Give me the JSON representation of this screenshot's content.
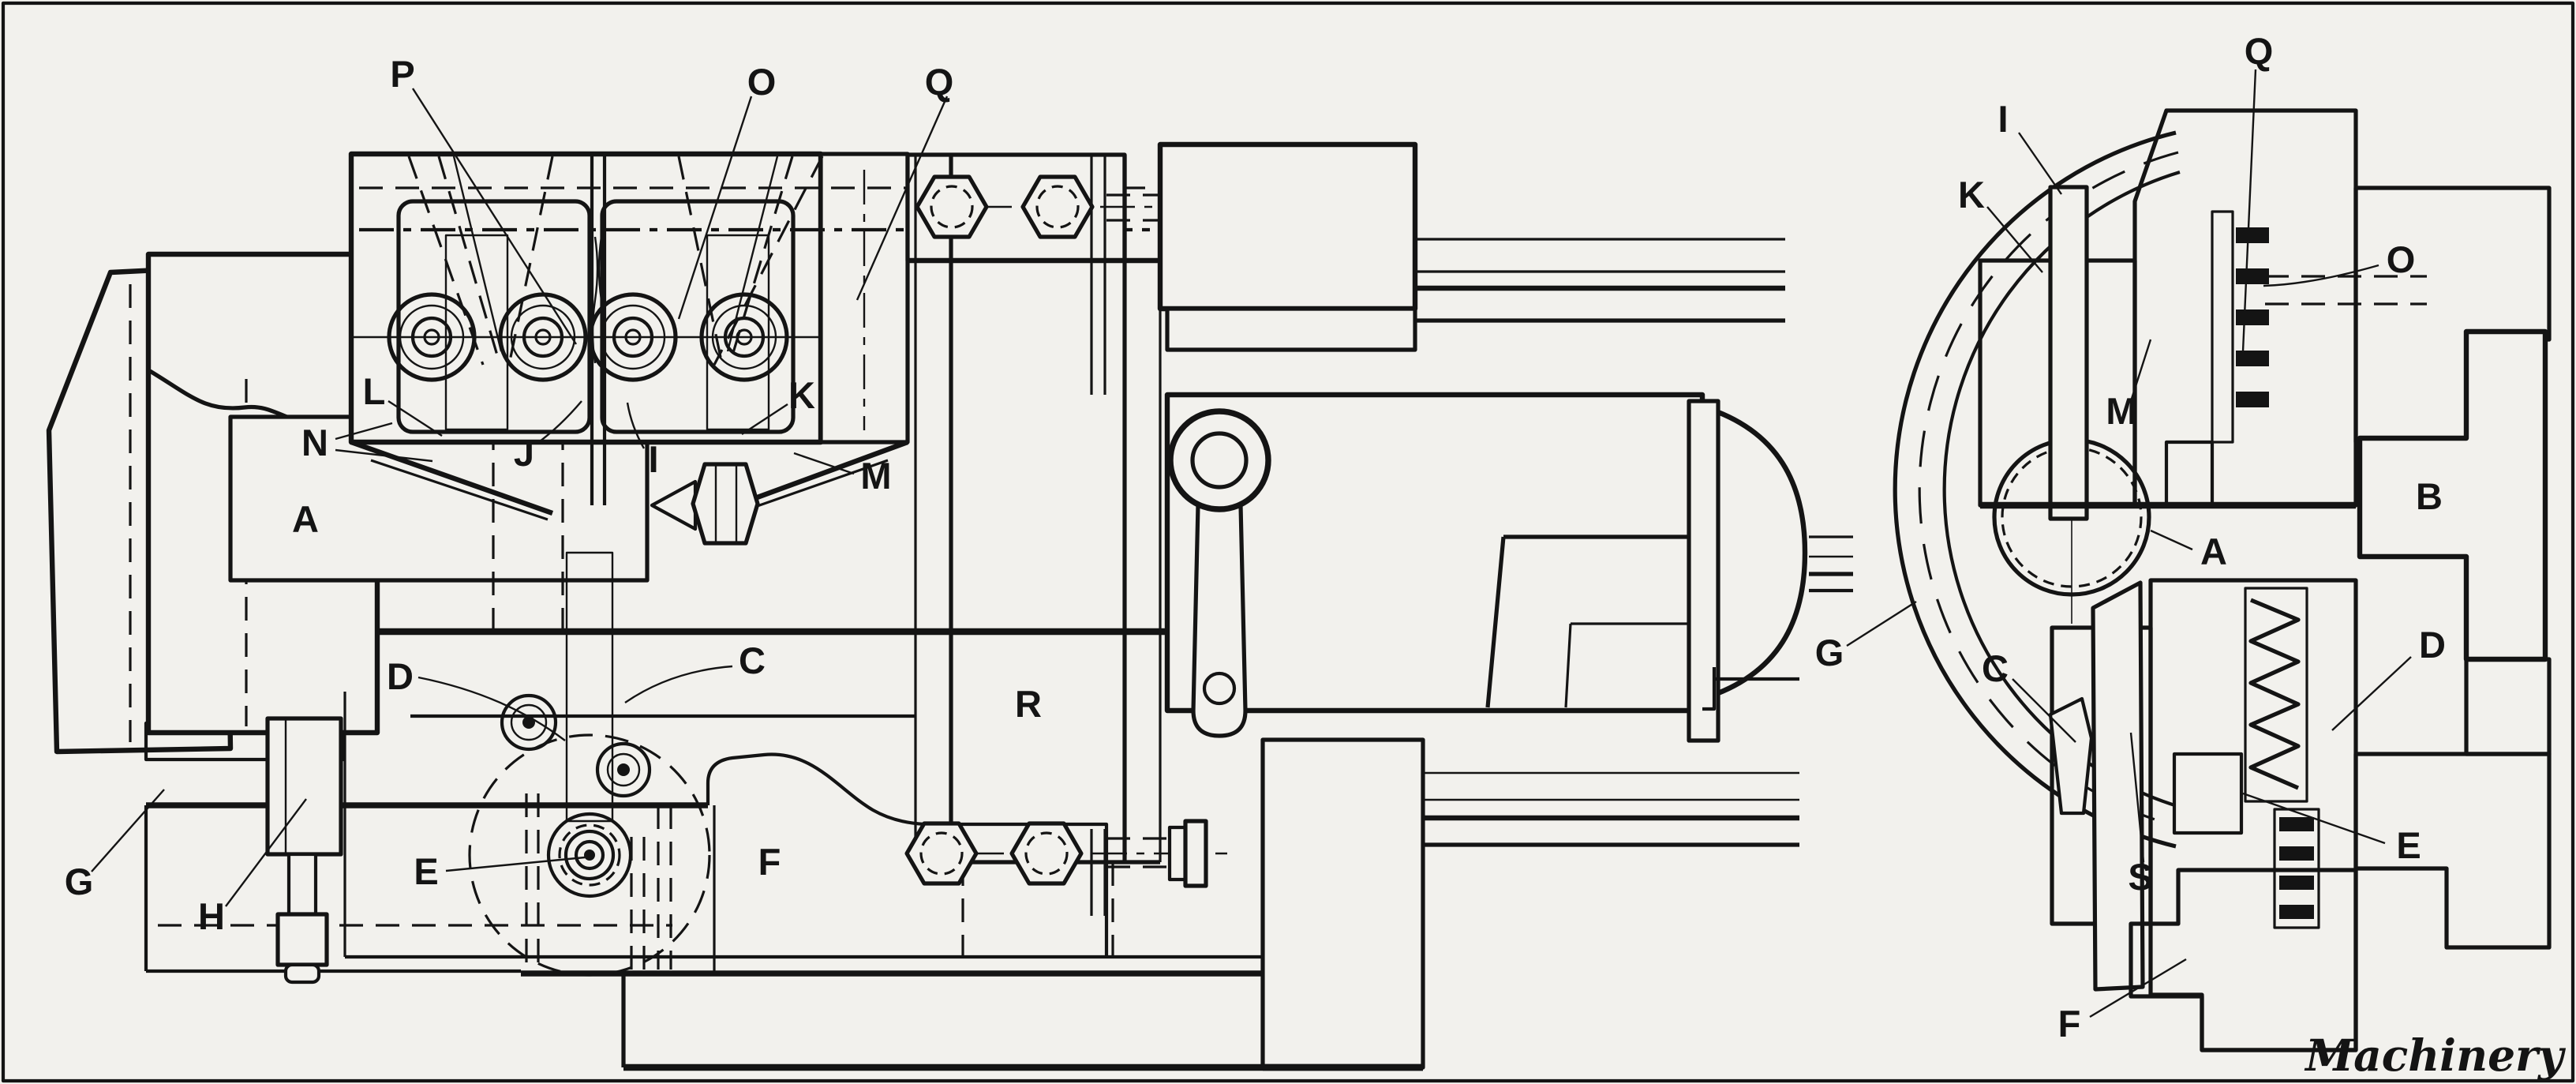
{
  "figure": {
    "caption": "Machinery",
    "background": "#f2f1ed",
    "ink_color": "#141414",
    "type": "engineering line drawing, two views of a machine tool mechanism"
  },
  "left_view": {
    "description": "plan view with reference letters",
    "labels": [
      {
        "id": "P",
        "text": "P"
      },
      {
        "id": "O",
        "text": "O"
      },
      {
        "id": "Q",
        "text": "Q"
      },
      {
        "id": "L",
        "text": "L"
      },
      {
        "id": "K",
        "text": "K"
      },
      {
        "id": "N",
        "text": "N"
      },
      {
        "id": "J",
        "text": "J"
      },
      {
        "id": "I",
        "text": "I"
      },
      {
        "id": "M",
        "text": "M"
      },
      {
        "id": "A",
        "text": "A"
      },
      {
        "id": "D",
        "text": "D"
      },
      {
        "id": "C",
        "text": "C"
      },
      {
        "id": "G",
        "text": "G"
      },
      {
        "id": "H",
        "text": "H"
      },
      {
        "id": "E",
        "text": "E"
      },
      {
        "id": "F",
        "text": "F"
      },
      {
        "id": "R",
        "text": "R"
      }
    ]
  },
  "right_view": {
    "description": "cross-section view with reference letters",
    "labels": [
      {
        "id": "Q",
        "text": "Q"
      },
      {
        "id": "I",
        "text": "I"
      },
      {
        "id": "K",
        "text": "K"
      },
      {
        "id": "O",
        "text": "O"
      },
      {
        "id": "M",
        "text": "M"
      },
      {
        "id": "B",
        "text": "B"
      },
      {
        "id": "A",
        "text": "A"
      },
      {
        "id": "C",
        "text": "C"
      },
      {
        "id": "D",
        "text": "D"
      },
      {
        "id": "G",
        "text": "G"
      },
      {
        "id": "S",
        "text": "S"
      },
      {
        "id": "E",
        "text": "E"
      },
      {
        "id": "F",
        "text": "F"
      }
    ]
  }
}
